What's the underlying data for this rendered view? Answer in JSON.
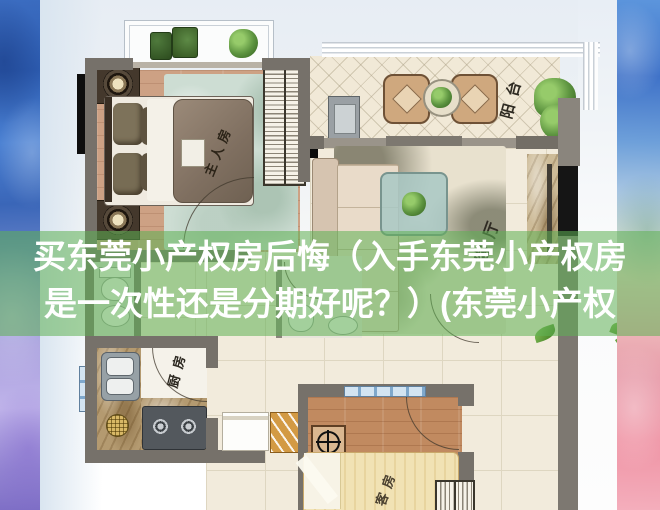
{
  "overlay": {
    "title_line1": "买东莞小产权房后悔（入手东莞小产权房",
    "title_line2": "是一次性还是分期好呢？）(东莞小产权",
    "band_color": "rgba(95,176,84,0.55)"
  },
  "floorplan": {
    "labels": {
      "master_bedroom": "主人房",
      "balcony": "阳台",
      "living_room": "客厅",
      "kitchen": "厨房",
      "guest_room": "客房"
    }
  },
  "palette": {
    "border_blue": "#3f72c8",
    "border_purple": "#a99fde",
    "border_pink": "#ef93a4",
    "wall_grey": "#76716a",
    "tile_beige": "#f2ebdc",
    "wood_floor": "#cda184",
    "overlay_green": "#5fb054",
    "title_text": "#ffffff"
  }
}
